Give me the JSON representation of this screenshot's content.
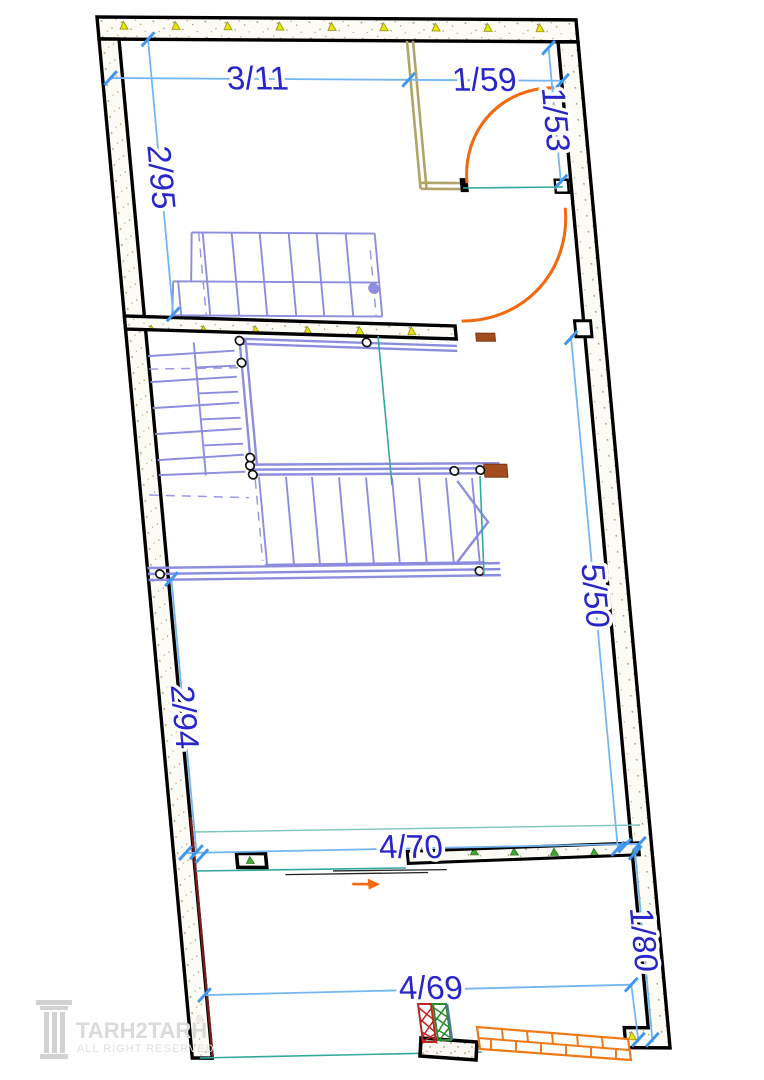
{
  "drawing": {
    "dims": {
      "top_left_width": "3/11",
      "top_room_width": "1/59",
      "top_room_depth": "1/53",
      "left_upper_height": "2/95",
      "right_height": "5/50",
      "left_lower_height": "2/94",
      "mid_lower_width": "4/70",
      "right_lower_height": "1/80",
      "bottom_width": "4/69"
    },
    "logo": {
      "brand": "TARH2TARH",
      "registered_mark": "®",
      "tagline": "ALL RIGHT RESERVED"
    },
    "colors": {
      "wall": "#000000",
      "dimension_line": "#74b6f2",
      "dimension_text": "#2826c8",
      "stair": "#8d8ddf",
      "door_swing": "#f26a10",
      "partition_tan": "#b0a468",
      "teal_guide": "#35a89e",
      "brick": "#ef7a18",
      "hatch_red": "#c32222",
      "hatch_green": "#2a8a2a",
      "triangle_yellow": "#e8e409",
      "triangle_green": "#43a832",
      "maroon_face": "#7a1a1a",
      "logo_gray": "#dadada"
    }
  }
}
